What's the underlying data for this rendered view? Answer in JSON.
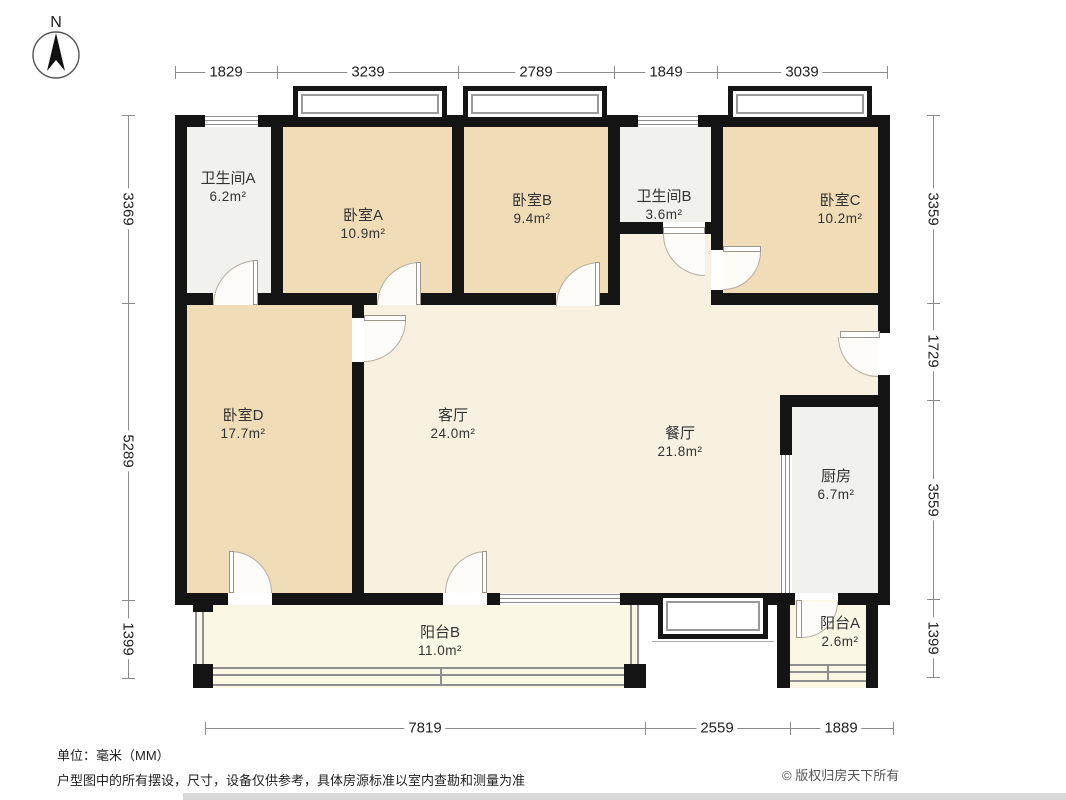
{
  "compass": {
    "label": "N"
  },
  "rooms": {
    "bathroom_a": {
      "name": "卫生间A",
      "area": "6.2m²"
    },
    "bedroom_a": {
      "name": "卧室A",
      "area": "10.9m²"
    },
    "bedroom_b": {
      "name": "卧室B",
      "area": "9.4m²"
    },
    "bathroom_b": {
      "name": "卫生间B",
      "area": "3.6m²"
    },
    "bedroom_c": {
      "name": "卧室C",
      "area": "10.2m²"
    },
    "bedroom_d": {
      "name": "卧室D",
      "area": "17.7m²"
    },
    "living": {
      "name": "客厅",
      "area": "24.0m²"
    },
    "dining": {
      "name": "餐厅",
      "area": "21.8m²"
    },
    "kitchen": {
      "name": "厨房",
      "area": "6.7m²"
    },
    "balcony_b": {
      "name": "阳台B",
      "area": "11.0m²"
    },
    "balcony_a": {
      "name": "阳台A",
      "area": "2.6m²"
    }
  },
  "dims": {
    "top": [
      "1829",
      "3239",
      "2789",
      "1849",
      "3039"
    ],
    "left": [
      "3369",
      "5289",
      "1399"
    ],
    "right": [
      "3359",
      "1729",
      "3559",
      "1399"
    ],
    "bottom": [
      "7819",
      "2559",
      "1889"
    ]
  },
  "footer": {
    "unit_note": "单位：毫米（MM）",
    "disclaimer": "户型图中的所有摆设，尺寸，设备仅供参考，具体房源标准以室内查勘和测量为准",
    "copyright": "© 版权归房天下所有"
  },
  "colors": {
    "wall": "#141414",
    "bedroom_fill": "#f0dcb6",
    "living_fill": "#f8f1e2",
    "wet_fill": "#f1f1ee",
    "balcony_fill": "#fbf7e5"
  }
}
